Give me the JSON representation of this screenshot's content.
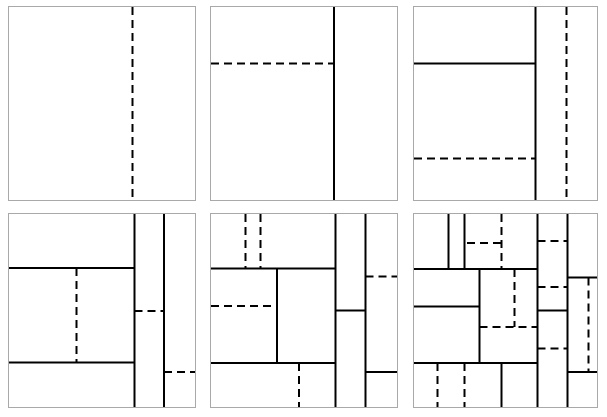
{
  "figure": {
    "background_color": "#ffffff",
    "panel_border_color": "#a9a9a9",
    "cut_color": "#000000",
    "cut_width_px": 2,
    "dash_on_px": 8,
    "dash_off_px": 5,
    "layout": {
      "rows": 2,
      "cols": 3,
      "panel_left_px": [
        8,
        210,
        413
      ],
      "panel_top_px": [
        6,
        213
      ],
      "panel_width_px": [
        188,
        188,
        185
      ],
      "panel_height_px": [
        195,
        195
      ]
    },
    "panels": [
      {
        "name": "partition-panel-1",
        "row": 0,
        "col": 0,
        "cuts": [
          {
            "dir": "v",
            "style": "dashed",
            "at": 0.665,
            "from": 0,
            "to": 1
          }
        ]
      },
      {
        "name": "partition-panel-2",
        "row": 0,
        "col": 1,
        "cuts": [
          {
            "dir": "v",
            "style": "solid",
            "at": 0.66,
            "from": 0,
            "to": 1
          },
          {
            "dir": "h",
            "style": "dashed",
            "at": 0.292,
            "from": 0,
            "to": 0.66
          }
        ]
      },
      {
        "name": "partition-panel-3",
        "row": 0,
        "col": 2,
        "cuts": [
          {
            "dir": "v",
            "style": "solid",
            "at": 0.665,
            "from": 0,
            "to": 1
          },
          {
            "dir": "v",
            "style": "dashed",
            "at": 0.832,
            "from": 0,
            "to": 1
          },
          {
            "dir": "h",
            "style": "solid",
            "at": 0.292,
            "from": 0,
            "to": 0.665
          },
          {
            "dir": "h",
            "style": "dashed",
            "at": 0.786,
            "from": 0,
            "to": 0.665
          }
        ]
      },
      {
        "name": "partition-panel-4",
        "row": 1,
        "col": 0,
        "cuts": [
          {
            "dir": "v",
            "style": "solid",
            "at": 0.674,
            "from": 0,
            "to": 1
          },
          {
            "dir": "v",
            "style": "solid",
            "at": 0.834,
            "from": 0,
            "to": 1
          },
          {
            "dir": "h",
            "style": "solid",
            "at": 0.281,
            "from": 0,
            "to": 0.674
          },
          {
            "dir": "h",
            "style": "solid",
            "at": 0.769,
            "from": 0,
            "to": 0.674
          },
          {
            "dir": "v",
            "style": "dashed",
            "at": 0.362,
            "from": 0.281,
            "to": 0.769
          },
          {
            "dir": "h",
            "style": "dashed",
            "at": 0.503,
            "from": 0.674,
            "to": 0.834
          },
          {
            "dir": "h",
            "style": "dashed",
            "at": 0.819,
            "from": 0.834,
            "to": 1
          }
        ]
      },
      {
        "name": "partition-panel-5",
        "row": 1,
        "col": 1,
        "cuts": [
          {
            "dir": "v",
            "style": "solid",
            "at": 0.67,
            "from": 0,
            "to": 1
          },
          {
            "dir": "v",
            "style": "solid",
            "at": 0.83,
            "from": 0,
            "to": 1
          },
          {
            "dir": "h",
            "style": "solid",
            "at": 0.282,
            "from": 0,
            "to": 0.67
          },
          {
            "dir": "v",
            "style": "dashed",
            "at": 0.186,
            "from": 0,
            "to": 0.282
          },
          {
            "dir": "v",
            "style": "dashed",
            "at": 0.266,
            "from": 0,
            "to": 0.282
          },
          {
            "dir": "v",
            "style": "solid",
            "at": 0.356,
            "from": 0.282,
            "to": 0.771
          },
          {
            "dir": "h",
            "style": "dashed",
            "at": 0.477,
            "from": 0,
            "to": 0.356
          },
          {
            "dir": "h",
            "style": "solid",
            "at": 0.771,
            "from": 0,
            "to": 0.67
          },
          {
            "dir": "v",
            "style": "dashed",
            "at": 0.473,
            "from": 0.771,
            "to": 1
          },
          {
            "dir": "h",
            "style": "solid",
            "at": 0.501,
            "from": 0.67,
            "to": 0.83
          },
          {
            "dir": "h",
            "style": "dashed",
            "at": 0.323,
            "from": 0.83,
            "to": 1
          },
          {
            "dir": "h",
            "style": "solid",
            "at": 0.819,
            "from": 0.83,
            "to": 1
          }
        ]
      },
      {
        "name": "partition-panel-6",
        "row": 1,
        "col": 2,
        "cuts": [
          {
            "dir": "v",
            "style": "solid",
            "at": 0.676,
            "from": 0,
            "to": 1
          },
          {
            "dir": "v",
            "style": "solid",
            "at": 0.838,
            "from": 0,
            "to": 1
          },
          {
            "dir": "v",
            "style": "solid",
            "at": 0.189,
            "from": 0,
            "to": 0.286
          },
          {
            "dir": "v",
            "style": "solid",
            "at": 0.276,
            "from": 0,
            "to": 0.286
          },
          {
            "dir": "v",
            "style": "dashed",
            "at": 0.479,
            "from": 0,
            "to": 0.286
          },
          {
            "dir": "h",
            "style": "dashed",
            "at": 0.15,
            "from": 0.29,
            "to": 0.479
          },
          {
            "dir": "h",
            "style": "solid",
            "at": 0.286,
            "from": 0,
            "to": 0.676
          },
          {
            "dir": "v",
            "style": "solid",
            "at": 0.357,
            "from": 0.286,
            "to": 0.773
          },
          {
            "dir": "h",
            "style": "solid",
            "at": 0.478,
            "from": 0,
            "to": 0.357
          },
          {
            "dir": "h",
            "style": "solid",
            "at": 0.773,
            "from": 0,
            "to": 0.676
          },
          {
            "dir": "v",
            "style": "dashed",
            "at": 0.548,
            "from": 0.286,
            "to": 0.585
          },
          {
            "dir": "h",
            "style": "dashed",
            "at": 0.585,
            "from": 0.357,
            "to": 0.676
          },
          {
            "dir": "h",
            "style": "dashed",
            "at": 0.14,
            "from": 0.676,
            "to": 0.838
          },
          {
            "dir": "h",
            "style": "dashed",
            "at": 0.379,
            "from": 0.676,
            "to": 0.838
          },
          {
            "dir": "h",
            "style": "solid",
            "at": 0.499,
            "from": 0.676,
            "to": 0.838
          },
          {
            "dir": "h",
            "style": "dashed",
            "at": 0.696,
            "from": 0.676,
            "to": 0.838
          },
          {
            "dir": "h",
            "style": "solid",
            "at": 0.328,
            "from": 0.838,
            "to": 1
          },
          {
            "dir": "v",
            "style": "dashed",
            "at": 0.953,
            "from": 0.328,
            "to": 0.819
          },
          {
            "dir": "h",
            "style": "solid",
            "at": 0.819,
            "from": 0.838,
            "to": 1
          },
          {
            "dir": "v",
            "style": "dashed",
            "at": 0.128,
            "from": 0.773,
            "to": 1
          },
          {
            "dir": "v",
            "style": "dashed",
            "at": 0.276,
            "from": 0.773,
            "to": 1
          },
          {
            "dir": "v",
            "style": "solid",
            "at": 0.479,
            "from": 0.773,
            "to": 1
          }
        ]
      }
    ]
  }
}
